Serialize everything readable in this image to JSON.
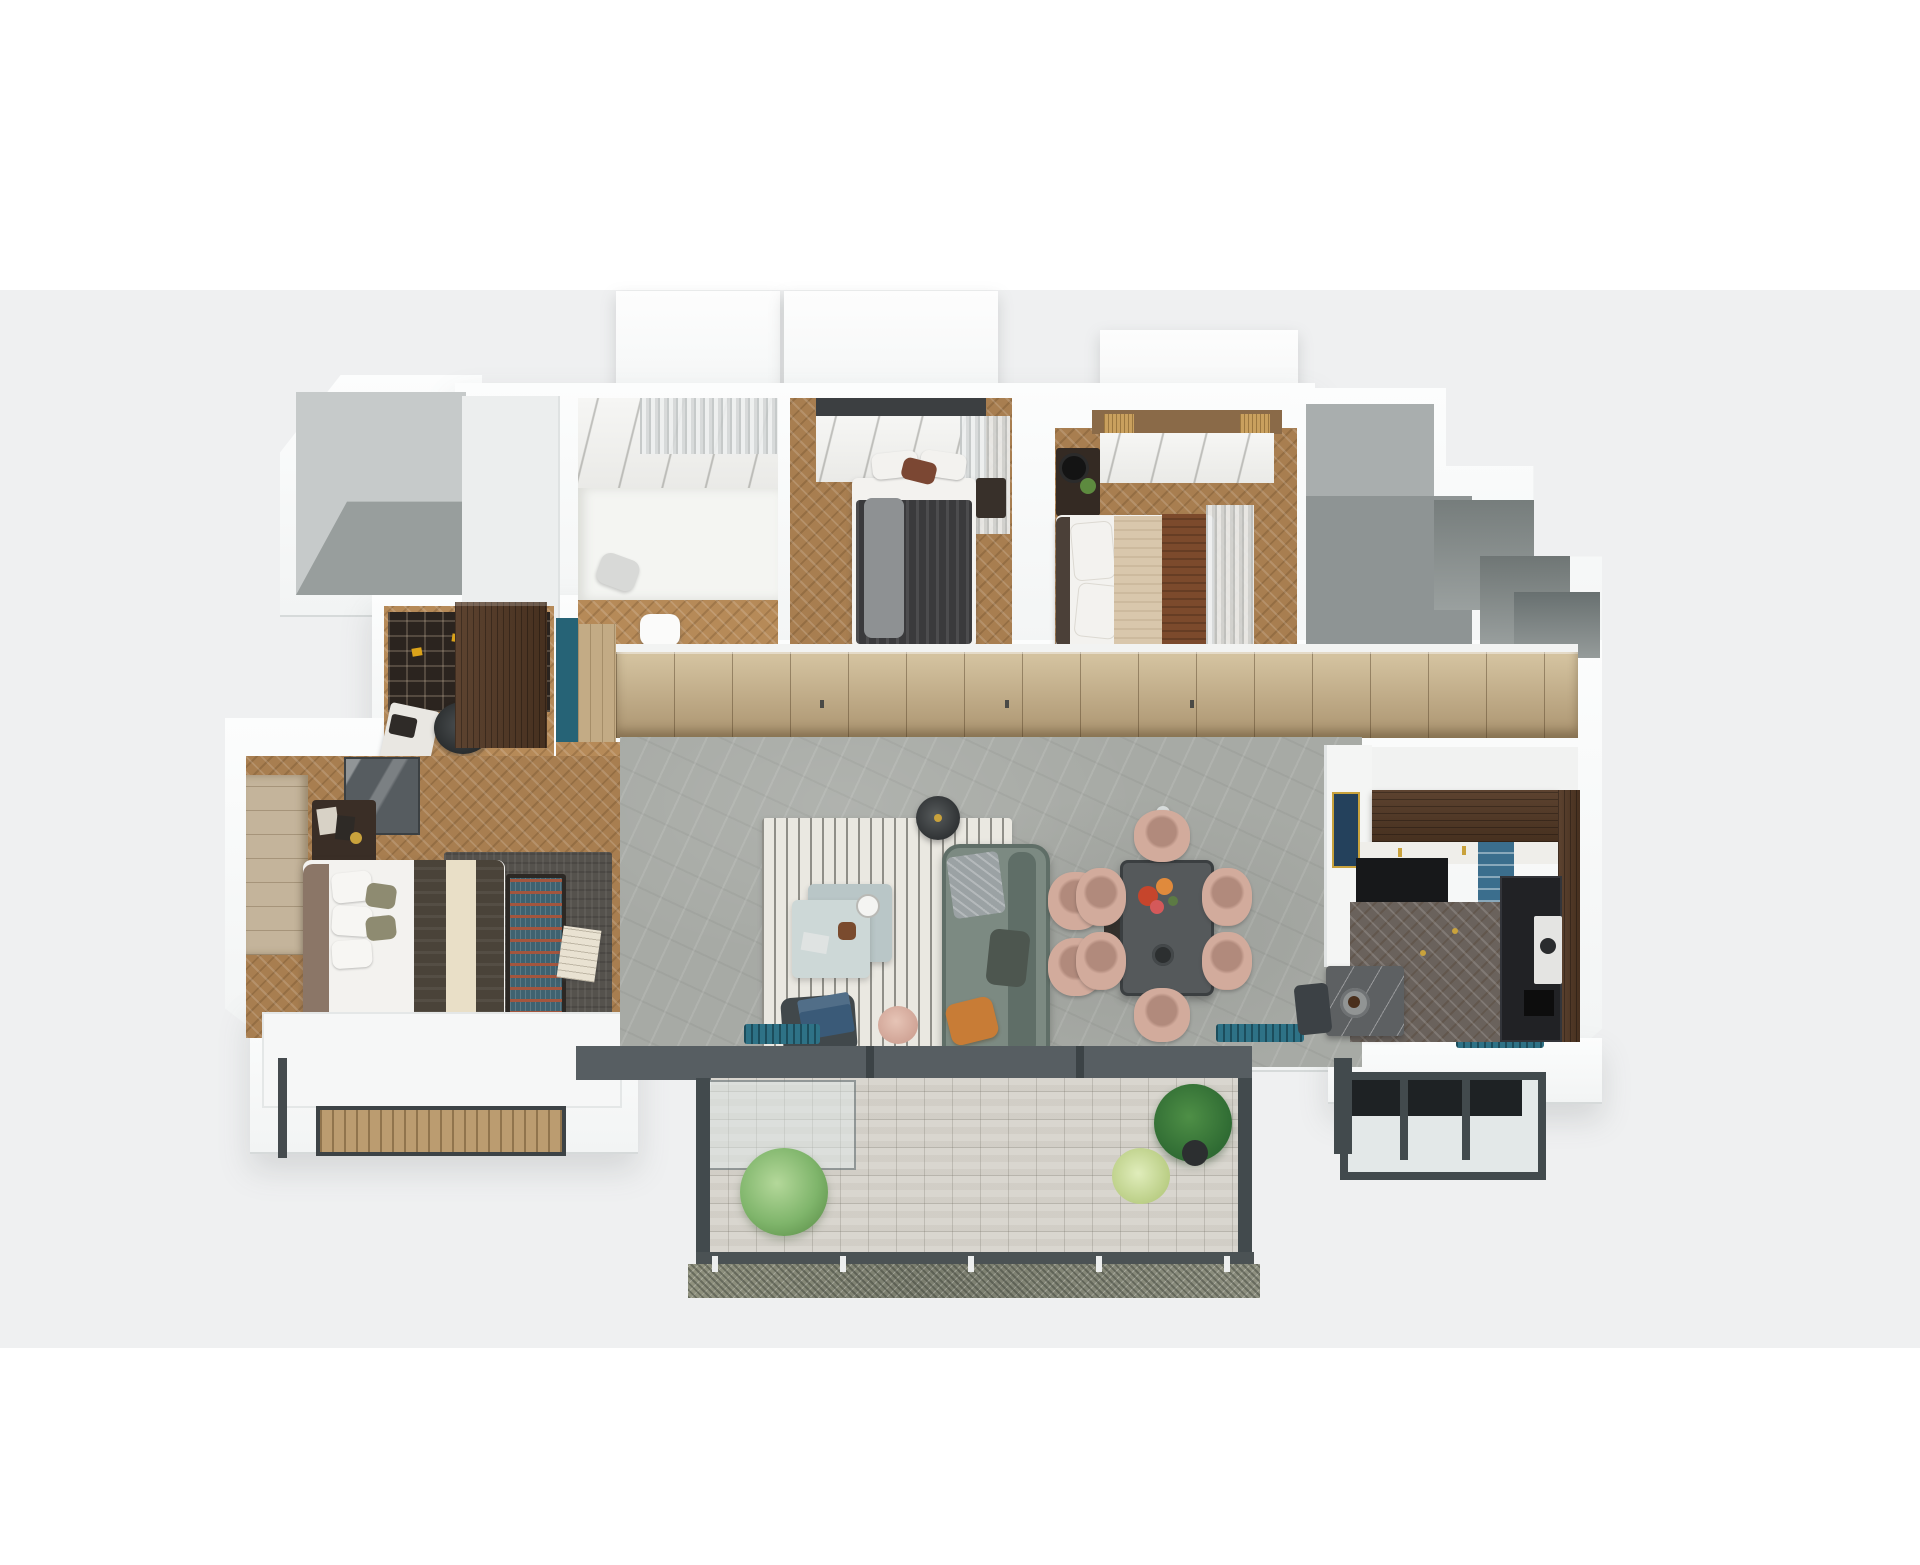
{
  "scene": {
    "type": "isometric-3d-apartment-floor-plan-render",
    "rooms": [
      {
        "id": "utility-gray-room"
      },
      {
        "id": "bathroom"
      },
      {
        "id": "bedroom-2"
      },
      {
        "id": "bedroom-3"
      },
      {
        "id": "stairwell-core"
      },
      {
        "id": "study"
      },
      {
        "id": "entry-hall"
      },
      {
        "id": "master-bedroom"
      },
      {
        "id": "living-room"
      },
      {
        "id": "dining-area"
      },
      {
        "id": "kitchen"
      },
      {
        "id": "bay-window"
      },
      {
        "id": "main-balcony"
      },
      {
        "id": "service-balcony"
      }
    ]
  },
  "palette": {
    "page": "#ffffff",
    "band": "#eff0f1",
    "grayWallFace": "#c6caca",
    "grayFloor": "#989e9d",
    "stairLight": "#a9aeae",
    "stairMid": "#8e9494",
    "marbleBase": "#f2f2ef",
    "woodLight": "#b68a58",
    "woodMid": "#a87e50",
    "kitchenFloor": "#6a625c",
    "teal": "#266376",
    "tealBench": "#2e7286",
    "bookshelf": "#2b241f",
    "gold": "#c9a23c",
    "yellow": "#dba31a",
    "livingFloor": "#a7aaa5",
    "rugWhite": "#eae8e1",
    "rugMaster": "#55524d",
    "sofa": "#7c8a82",
    "sofaDark": "#5f6e67",
    "throwGray": "#9ba2a4",
    "pillowOrange": "#c87c36",
    "blush": "#d2ab9c",
    "blushDark": "#b18a7c",
    "tableDark": "#55595b",
    "tableEdge": "#3b3f41",
    "pendant": "#d6dbda",
    "flowersRed": "#c6452c",
    "flowersOrange": "#e08a3c",
    "bedWhite": "#f3f2ef",
    "bed2Blanket": "#3a3a3c",
    "pillowBrown": "#7b4733",
    "bed3Beige": "#d9c7ac",
    "bed3Brown": "#7c4a2c",
    "benchWood": "#4a3729",
    "masterBlanket": "#4a4339",
    "cream": "#e9dfc7",
    "headboard": "#8b7667",
    "olivePillow": "#8e8b71",
    "benchZig": "#3f6270",
    "zigRed": "#a4563e",
    "glassCab": "#565c60",
    "artNavy": "#24415c",
    "blueShelf": "#3b6e8d",
    "black": "#17181a",
    "appliance": "#212225",
    "balconyTile": "#d9d6cf",
    "frameDark": "#424a4d",
    "railBar": "#4b5254",
    "glass": "#e3e8e8",
    "plantGreen": "#82b76c",
    "plantDark": "#35703a",
    "plantYellow": "#cbdd9b",
    "potDark": "#2c2f30",
    "wallSoft": "#f1f2f1"
  }
}
